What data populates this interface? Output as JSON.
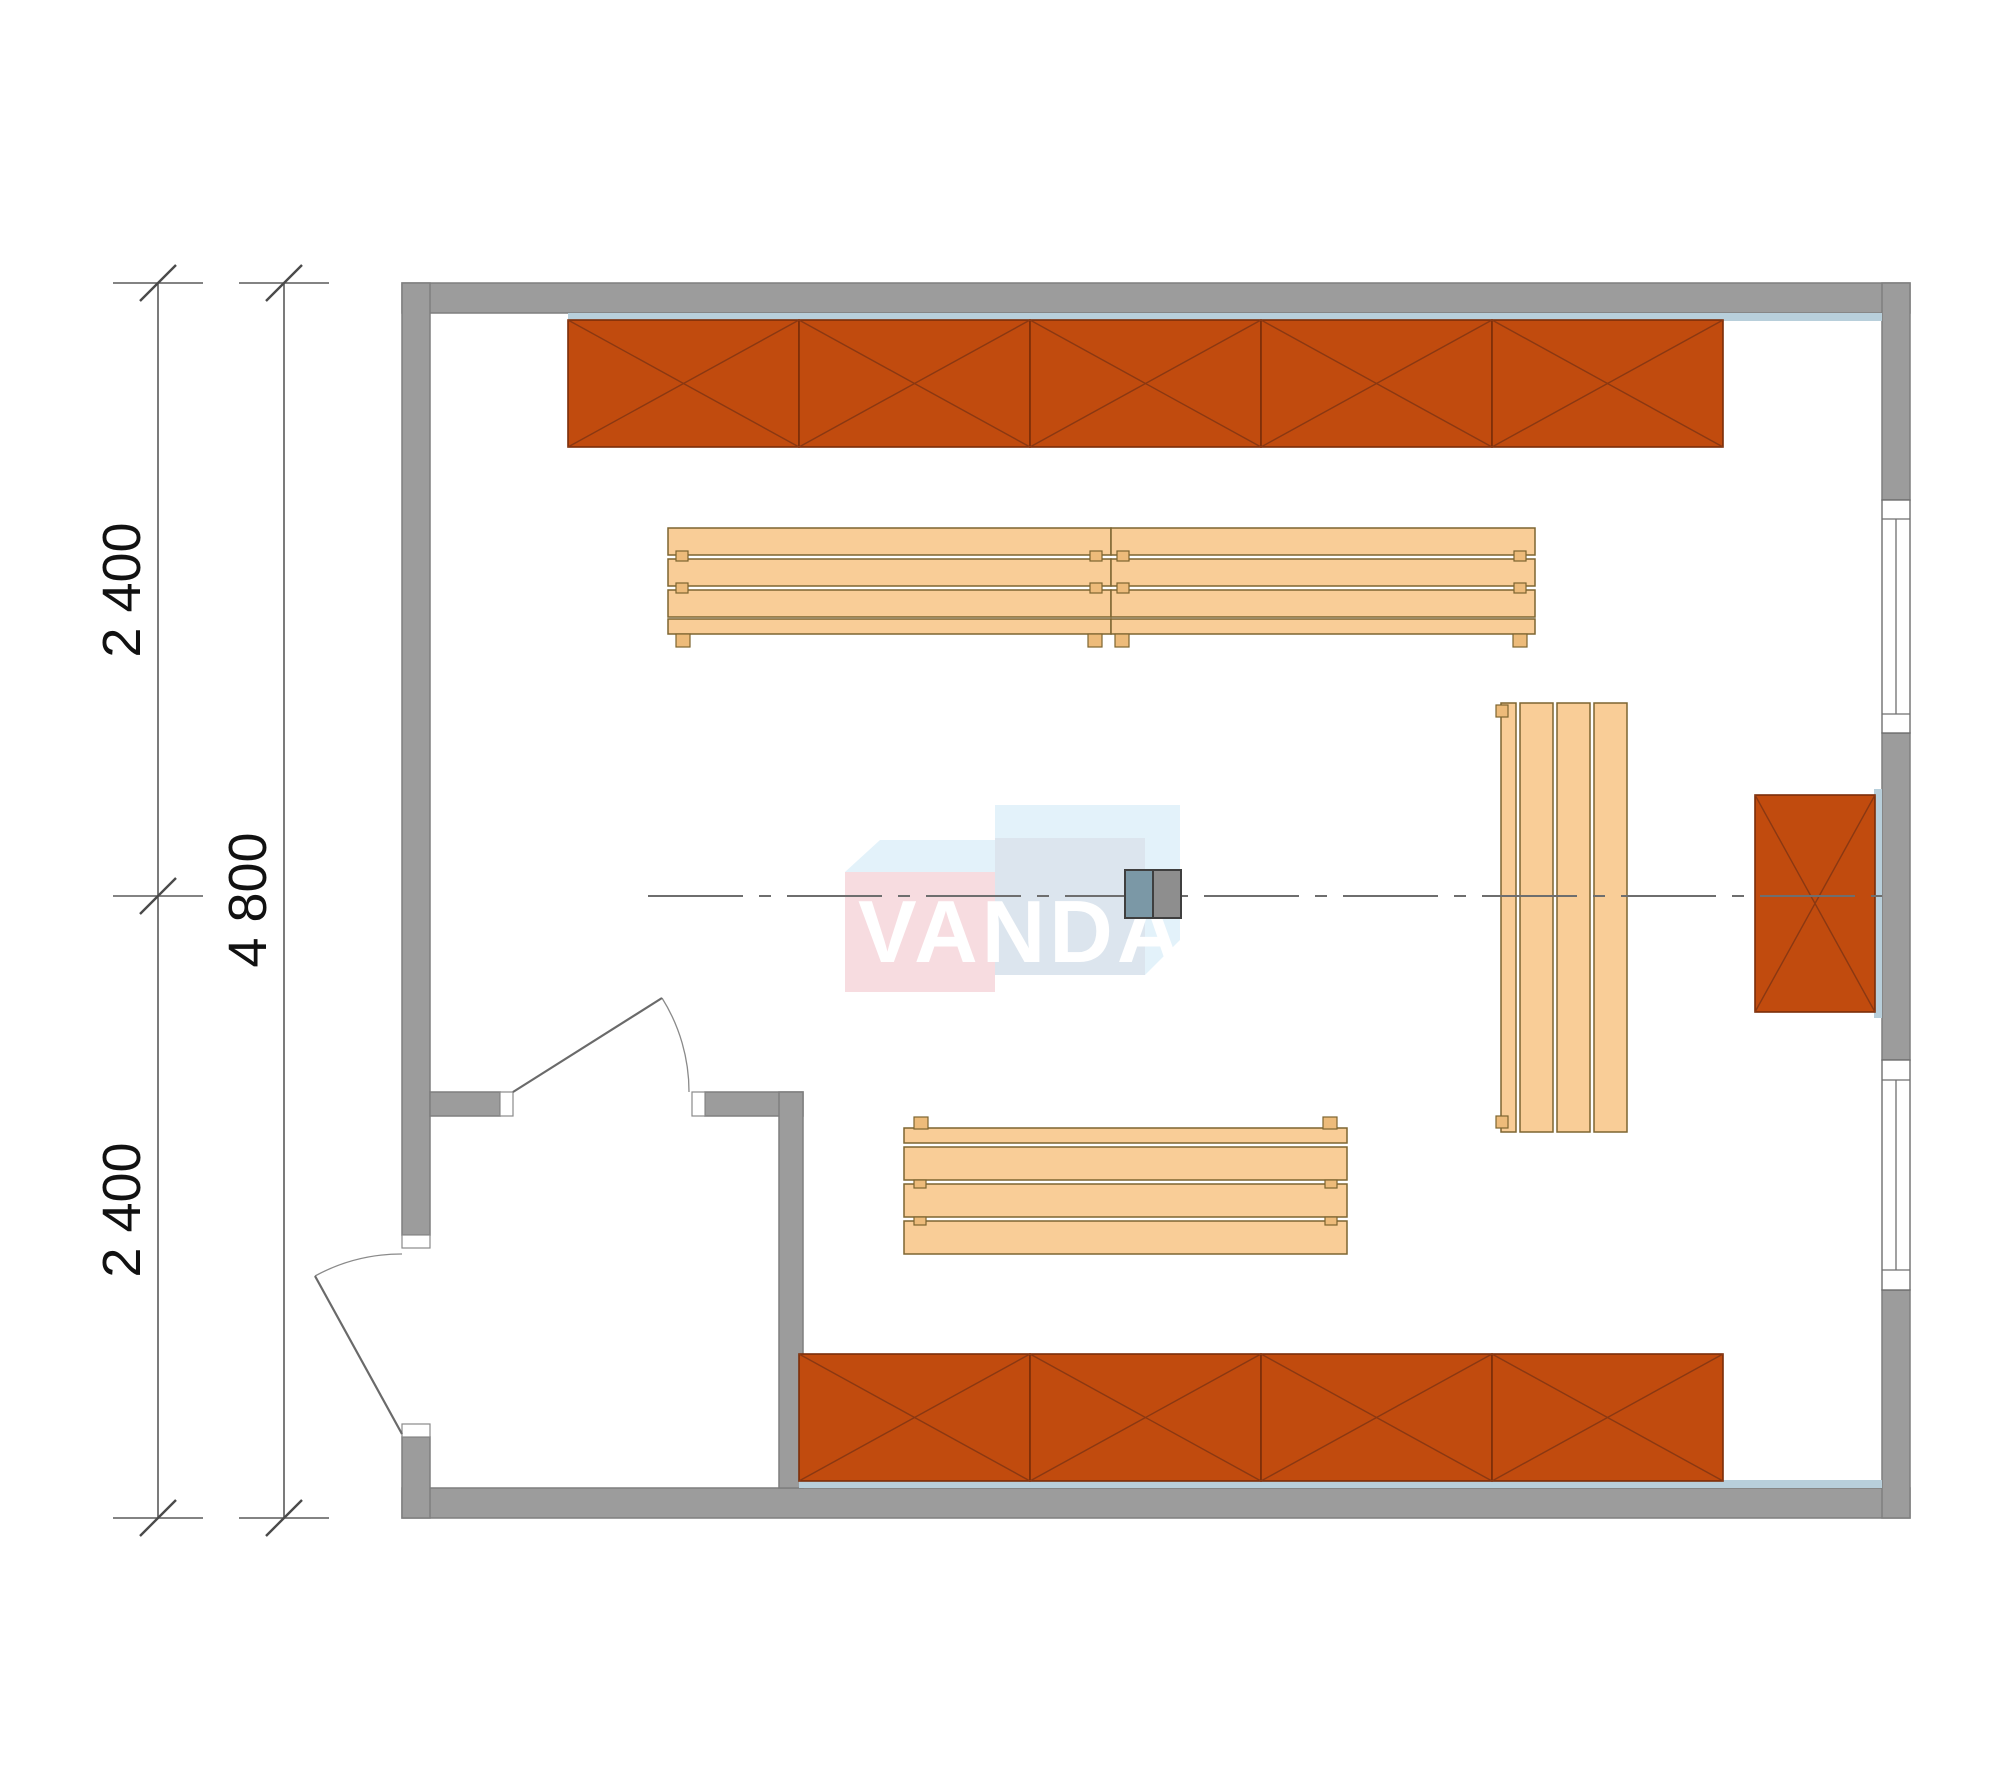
{
  "dimensions": {
    "upper_segment": "2 400",
    "total": "4 800",
    "lower_segment": "2 400"
  },
  "watermark": {
    "text": "VANDA"
  },
  "colors": {
    "wall": "#9c9c9c",
    "wall_liner": "#b8cfdb",
    "shelving": "#c14b0e",
    "bench": "#f9cd97",
    "bench_foot": "#edbb7a",
    "heater_left": "#7b98a6",
    "heater_right": "#8e8e8e",
    "logo_pink": "#f2c3cb",
    "logo_blue_top": "#cfe9f8",
    "logo_blue_front": "#c4d4e2",
    "logo_text": "#ffffff"
  },
  "elements": {
    "shelving_cells_top_row": 5,
    "shelving_cells_bottom_row": 4,
    "shelving_cells_right_wall": 1,
    "benches_top_row": 2,
    "bench_right_vertical": 1,
    "bench_bottom": 1,
    "windows_right_wall": 2,
    "doors": 2,
    "heater_blocks": 1
  }
}
